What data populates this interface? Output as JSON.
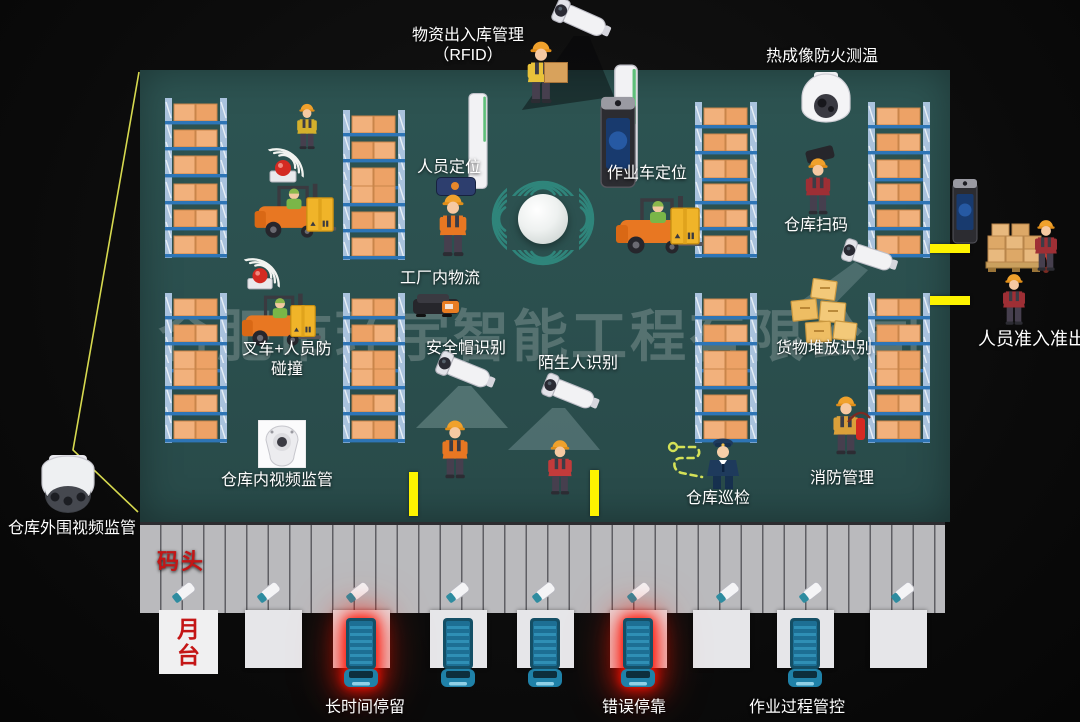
{
  "watermark": "合肥市环宇智能工程有限公司",
  "features": {
    "rfid_title": "物资出入库管理",
    "rfid_sub": "（RFID）",
    "thermal": "热成像防火测温",
    "person_positioning": "人员定位",
    "vehicle_positioning": "作业车定位",
    "factory_logistics": "工厂内物流",
    "forklift_collision_line1": "叉车+人员防",
    "forklift_collision_line2": "碰撞",
    "helmet_recognition": "安全帽识别",
    "stranger_recognition": "陌生人识别",
    "warehouse_scanning": "仓库扫码",
    "cargo_stacking_recognition": "货物堆放识别",
    "personnel_access": "人员准入准出",
    "indoor_video": "仓库内视频监管",
    "warehouse_patrol": "仓库巡检",
    "fire_management": "消防管理",
    "perimeter_video": "仓库外围视频监管"
  },
  "dock": {
    "dock_label": "码头",
    "platform_line1": "月",
    "platform_line2": "台",
    "long_stay": "长时间停留",
    "wrong_docking": "错误停靠",
    "process_control": "作业过程管控"
  },
  "colors": {
    "floor_teal": "#2B504E",
    "signal_teal": "#2F857B",
    "highlight_yellow": "#FDF300",
    "alert_red": "#FF1A00",
    "red_text": "#C41616",
    "watermark_gray": "#BAC5C2"
  }
}
